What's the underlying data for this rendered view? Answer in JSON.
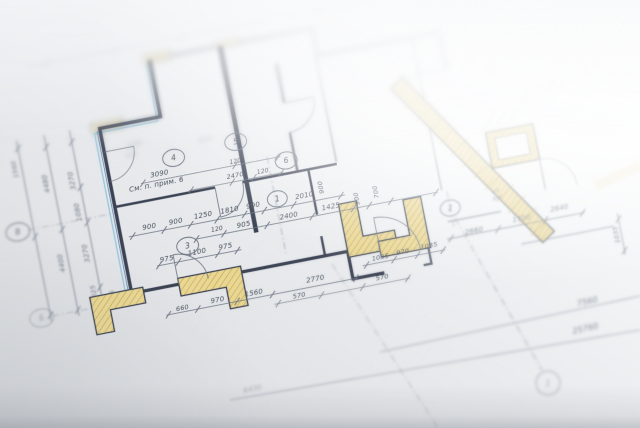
{
  "colors": {
    "paper_light": "#ffffff",
    "paper_mid": "#e8eaec",
    "paper_dark": "#d6d9dd",
    "wall": "#3a4353",
    "thin": "#6a7382",
    "dash": "#7b8392",
    "accent_cyan": "#8cc3da",
    "accent_blue": "#5f86b5",
    "pillar_fill": "#e9d793",
    "pillar_hatch": "#bb9e52",
    "text_focus": "#47515f",
    "text_soft": "#5c6675",
    "text_far": "#97a0ab"
  },
  "rotation_deg": -11,
  "note": "См. п. прим. 6",
  "walls": [
    {
      "d": "M120,256 L120,88 L182,88 L182,30",
      "w": 3.5,
      "z": "focus"
    },
    {
      "d": "M182,30 L348,30 L348,58 L472,58 L472,96",
      "w": 3,
      "z": "far",
      "o": 0.75
    },
    {
      "d": "M120,168 L222,168",
      "w": 2.5,
      "z": "focus"
    },
    {
      "d": "M250,168 L346,168",
      "w": 2.5,
      "z": "focus"
    },
    {
      "d": "M254,30 L254,220",
      "w": 4.5,
      "z": "focus"
    },
    {
      "d": "M306,58 L306,98",
      "w": 2.2,
      "z": "soft"
    },
    {
      "d": "M306,128 L306,168",
      "w": 2.2,
      "z": "soft"
    },
    {
      "d": "M346,58 L346,166",
      "w": 1.6,
      "z": "soft",
      "o": 0.6
    },
    {
      "d": "M317,168 L317,214",
      "w": 2.4,
      "z": "focus"
    },
    {
      "d": "M317,236 L317,256",
      "w": 2.4,
      "z": "focus"
    },
    {
      "d": "M120,256 L168,256",
      "w": 3.2,
      "z": "focus"
    },
    {
      "d": "M198,256 L340,256 L340,284 L372,284",
      "w": 3.2,
      "z": "focus"
    },
    {
      "d": "M412,284 L420,284 L420,216",
      "w": 2.2,
      "z": "focus",
      "o": 0.85
    },
    {
      "d": "M444,58 L444,214",
      "w": 1.4,
      "z": "soft",
      "o": 0.5
    },
    {
      "d": "M444,246 L498,246",
      "w": 1.4,
      "z": "soft",
      "o": 0.5
    },
    {
      "d": "M512,282 L606,282",
      "w": 1.2,
      "z": "soft",
      "o": 0.4
    },
    {
      "d": "M546,166 L546,232",
      "w": 1.2,
      "z": "soft",
      "o": 0.45
    },
    {
      "d": "M424,96 L472,96",
      "w": 1.4,
      "z": "far",
      "o": 0.5
    }
  ],
  "accents": [
    {
      "d": "M114,252 L114,92 L178,92 L178,34",
      "c": "accent_cyan",
      "w": 1.3,
      "z": "focus",
      "o": 0.9
    },
    {
      "d": "M117,254 L117,90",
      "c": "accent_blue",
      "w": 1,
      "z": "focus",
      "o": 0.8
    }
  ],
  "pillars": [
    {
      "pts": "78,252 132,252 132,268 96,268 96,290 78,290",
      "z": "focus"
    },
    {
      "pts": "168,250 232,250 232,290 214,290 214,268 168,268",
      "z": "focus"
    },
    {
      "pts": "340,208 358,208 358,244 390,244 390,262 340,262",
      "z": "focus"
    },
    {
      "pts": "404,216 422,216 422,268 372,268 372,252 404,252",
      "z": "focus"
    },
    {
      "pts": "498,166 546,166 546,202 498,202",
      "z": "soft"
    },
    {
      "pts": "506,173 538,173 538,195 506,195",
      "z": "soft",
      "fill": "#f6f7f8",
      "sw": 1
    },
    {
      "pts": "176,24 204,24 204,34 176,34",
      "z": "far",
      "o": 0.6
    },
    {
      "pts": "112,82 144,82 144,92 112,92",
      "z": "far",
      "o": 0.6
    },
    {
      "pts": "250,24 274,24 274,33 250,33",
      "z": "far",
      "o": 0.55
    }
  ],
  "strip": {
    "x1": 420,
    "y1": 100,
    "x2": 540,
    "y2": 280,
    "w": 16,
    "z": "soft"
  },
  "arcs": [
    {
      "d": "M168,256 L168,226 A30 30 0 0 1 198,256",
      "z": "focus"
    },
    {
      "d": "M222,168 L222,198 A28 28 0 0 0 250,168",
      "z": "focus"
    },
    {
      "d": "M306,98 L336,98 A30 30 0 0 1 306,128",
      "z": "soft"
    },
    {
      "d": "M372,268 L372,228 A40 40 0 0 1 412,268",
      "z": "focus",
      "o": 0.85
    },
    {
      "d": "M546,234 L546,202 A32 32 0 0 1 578,234",
      "z": "soft",
      "o": 0.5
    },
    {
      "d": "M120,112 L150,112 A30 30 0 0 1 120,142",
      "z": "focus",
      "o": 0.7
    }
  ],
  "dashes": [
    {
      "p": [
        279,
        148,
        279,
        246
      ],
      "z": "soft"
    },
    {
      "p": [
        358,
        14,
        358,
        58
      ],
      "z": "far"
    },
    {
      "p": [
        30,
        174,
        120,
        174
      ],
      "z": "soft",
      "o": 0.6
    },
    {
      "p": [
        38,
        263,
        120,
        263
      ],
      "z": "soft",
      "o": 0.6
    },
    {
      "p": [
        449,
        216,
        449,
        252
      ],
      "z": "soft"
    }
  ],
  "chains": [
    {
      "p": [
        36,
        84,
        36,
        268
      ],
      "t": [
        92,
        182,
        262
      ],
      "z": "soft"
    },
    {
      "p": [
        64,
        84,
        64,
        268
      ],
      "t": [
        96,
        180,
        262
      ],
      "z": "soft"
    },
    {
      "p": [
        90,
        84,
        90,
        268
      ],
      "t": [
        96,
        142,
        178,
        244,
        264
      ],
      "z": "soft"
    },
    {
      "p": [
        128,
        200,
        348,
        200
      ],
      "t": [
        132,
        164,
        191,
        218,
        246,
        266,
        296,
        344
      ],
      "z": "focus"
    },
    {
      "p": [
        192,
        215,
        440,
        215
      ],
      "t": [
        194,
        222,
        266,
        312,
        354,
        370,
        392,
        438
      ],
      "z": "focus"
    },
    {
      "p": [
        150,
        234,
        236,
        234
      ],
      "t": [
        152,
        172,
        212,
        232
      ],
      "z": "focus"
    },
    {
      "p": [
        150,
        284,
        345,
        284
      ],
      "t": [
        152,
        182,
        222,
        258,
        343
      ],
      "z": "focus"
    },
    {
      "p": [
        258,
        294,
        396,
        294
      ],
      "t": [
        262,
        306,
        348,
        394
      ],
      "z": "focus",
      "o": 0.75
    },
    {
      "p": [
        352,
        273,
        436,
        273
      ],
      "t": [
        356,
        384,
        408,
        434
      ],
      "z": "focus",
      "o": 0.9
    },
    {
      "p": [
        440,
        263,
        580,
        263
      ],
      "t": [
        444,
        492,
        540,
        578
      ],
      "z": "soft"
    },
    {
      "p": [
        612,
        270,
        612,
        312
      ],
      "t": [
        276,
        308
      ],
      "z": "soft",
      "o": 0.8
    },
    {
      "p": [
        150,
        150,
        292,
        150
      ],
      "t": [
        152,
        246,
        290
      ],
      "z": "focus",
      "o": 0.85
    },
    {
      "p": [
        196,
        166,
        292,
        166
      ],
      "t": [
        198,
        240,
        262,
        290
      ],
      "z": "focus",
      "o": 0.8
    },
    {
      "p": [
        60,
        14,
        430,
        14
      ],
      "t": [
        80,
        150,
        220,
        290,
        360
      ],
      "z": "far",
      "o": 0.45
    }
  ],
  "labels": [
    [
      "900",
      150,
      196,
      7
    ],
    [
      "900",
      177,
      196,
      7
    ],
    [
      "1250",
      205,
      195,
      7
    ],
    [
      "1810",
      232,
      195,
      7
    ],
    [
      "900",
      256,
      195,
      7
    ],
    [
      "2010",
      308,
      195,
      7
    ],
    [
      "900",
      328,
      188,
      6.5,
      -90
    ],
    [
      "120",
      216,
      211,
      6
    ],
    [
      "905",
      243,
      212,
      7
    ],
    [
      "2400",
      289,
      212,
      7
    ],
    [
      "1425",
      332,
      211,
      7
    ],
    [
      "900",
      361,
      206,
      6.5,
      -90
    ],
    [
      "700",
      381,
      203,
      6.5,
      -90
    ],
    [
      "975",
      161,
      231,
      7
    ],
    [
      "1100",
      192,
      230,
      7
    ],
    [
      "975",
      221,
      230,
      7
    ],
    [
      "660",
      167,
      282,
      6.5
    ],
    [
      "970",
      203,
      281,
      7
    ],
    [
      "1560",
      240,
      281,
      7
    ],
    [
      "2770",
      303,
      279,
      7
    ],
    [
      "570",
      284,
      292,
      6.5
    ],
    [
      "570",
      369,
      290,
      6.5
    ],
    [
      "1035",
      371,
      270,
      6.5
    ],
    [
      "970",
      394,
      269,
      6.5
    ],
    [
      "1035",
      421,
      268,
      6.5
    ],
    [
      "3090",
      170,
      146,
      7
    ],
    [
      "120",
      247,
      148,
      6
    ],
    [
      "2470",
      244,
      162,
      6.5
    ],
    [
      "120",
      272,
      163,
      6
    ],
    [
      "См. п. прим. 6",
      165,
      156,
      7.2
    ],
    [
      "1560",
      31,
      112,
      6.5,
      -90,
      "soft"
    ],
    [
      "4480",
      59,
      132,
      7,
      -90,
      "soft"
    ],
    [
      "4400",
      59,
      213,
      7,
      -90,
      "soft"
    ],
    [
      "3270",
      85,
      134,
      7,
      -90,
      "soft"
    ],
    [
      "1080",
      85,
      166,
      7,
      -90,
      "soft"
    ],
    [
      "3270",
      85,
      208,
      7,
      -90,
      "soft"
    ],
    [
      "1025",
      85,
      249,
      6.5,
      -90,
      "soft"
    ],
    [
      "1075",
      103,
      257,
      6,
      -90,
      "soft"
    ],
    [
      "2660",
      468,
      262,
      7,
      0,
      "soft"
    ],
    [
      "1700",
      517,
      259,
      7,
      0,
      "soft"
    ],
    [
      "2640",
      556,
      256,
      7,
      0,
      "soft"
    ],
    [
      "1035",
      609,
      291,
      6.5,
      -90,
      "soft"
    ],
    [
      "29",
      497,
      227,
      5.5,
      0,
      "soft",
      0.85
    ],
    [
      "БМ",
      497,
      234,
      5.5,
      0,
      "soft",
      0.85
    ],
    [
      "1000",
      151,
      112,
      6,
      0,
      "far"
    ],
    [
      "520",
      146,
      122,
      6,
      0,
      "far"
    ],
    [
      "1670",
      221,
      121,
      6,
      0,
      "far"
    ]
  ],
  "circles": [
    {
      "x": 187,
      "y": 131,
      "rx": 11,
      "ry": 8.5,
      "label": "4",
      "z": "focus"
    },
    {
      "x": 251,
      "y": 127,
      "rx": 11,
      "ry": 8.5,
      "label": "5",
      "z": "focus"
    },
    {
      "x": 297,
      "y": 155,
      "rx": 11,
      "ry": 8.5,
      "label": "6",
      "z": "focus"
    },
    {
      "x": 184,
      "y": 220,
      "rx": 11,
      "ry": 8.5,
      "label": "3",
      "z": "focus"
    },
    {
      "x": 281,
      "y": 191,
      "rx": 10,
      "ry": 8,
      "label": "1",
      "z": "focus"
    },
    {
      "x": 449,
      "y": 233,
      "rx": 10,
      "ry": 8,
      "label": "2",
      "z": "soft"
    },
    {
      "x": 20,
      "y": 174,
      "rx": 12,
      "ry": 9,
      "label": "В",
      "z": "soft"
    },
    {
      "x": 27,
      "y": 263,
      "rx": 12,
      "ry": 9,
      "label": "Б",
      "z": "soft",
      "o": 0.55
    },
    {
      "x": 358,
      "y": 8,
      "rx": 8,
      "ry": 7,
      "label": "",
      "z": "far",
      "o": 0.5
    }
  ],
  "overlay": {
    "lines": [
      [
        380,
        352,
        640,
        296,
        0,
        0.8,
        0.7
      ],
      [
        230,
        400,
        640,
        330,
        0,
        0.8,
        0.7
      ],
      [
        332,
        264,
        438,
        428,
        1,
        0.8,
        0.5
      ],
      [
        455,
        218,
        542,
        370,
        1,
        0.9,
        0.6
      ]
    ],
    "labels": [
      [
        "7560",
        588,
        304,
        8,
        -12.5,
        0.85
      ],
      [
        "25760",
        586,
        331,
        8,
        -12.5,
        0.85
      ],
      [
        "6430",
        253,
        391,
        7,
        -12.5,
        0.5
      ]
    ],
    "circle": {
      "x": 548,
      "y": 383,
      "r": 12,
      "label": "1",
      "o": 0.55
    },
    "stairs": {
      "n": 6
    },
    "yellow_traces": [
      [
        470,
        45,
        620,
        22,
        8,
        0.22
      ],
      [
        595,
        186,
        640,
        166,
        10,
        0.28
      ],
      [
        545,
        62,
        582,
        52,
        7,
        0.2
      ]
    ]
  }
}
